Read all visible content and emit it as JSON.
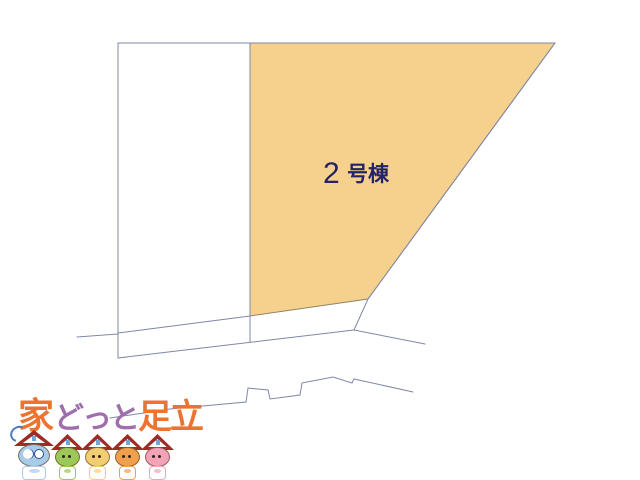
{
  "diagram": {
    "parcel": {
      "number": "2",
      "suffix": "号棟",
      "label": "2号棟"
    },
    "colors": {
      "parcel_fill": "#F6D18D",
      "parcel_border": "#8F8569",
      "line": "#8087A8",
      "label_text": "#232366"
    }
  },
  "logo": {
    "brand_parts": [
      {
        "text": "家",
        "color": "#ED7331"
      },
      {
        "text": "どっと",
        "color": "#9F6FAC"
      },
      {
        "text": "足立",
        "color": "#ED7331"
      }
    ],
    "mascots": [
      {
        "name": "mascot-blue",
        "face": "#A8CBE8"
      },
      {
        "name": "mascot-green",
        "face": "#9CC85A"
      },
      {
        "name": "mascot-yellow",
        "face": "#F2CE72"
      },
      {
        "name": "mascot-orange",
        "face": "#F0A04C"
      },
      {
        "name": "mascot-pink",
        "face": "#F4A2B8"
      }
    ],
    "roof_color": "#9C2D24"
  }
}
